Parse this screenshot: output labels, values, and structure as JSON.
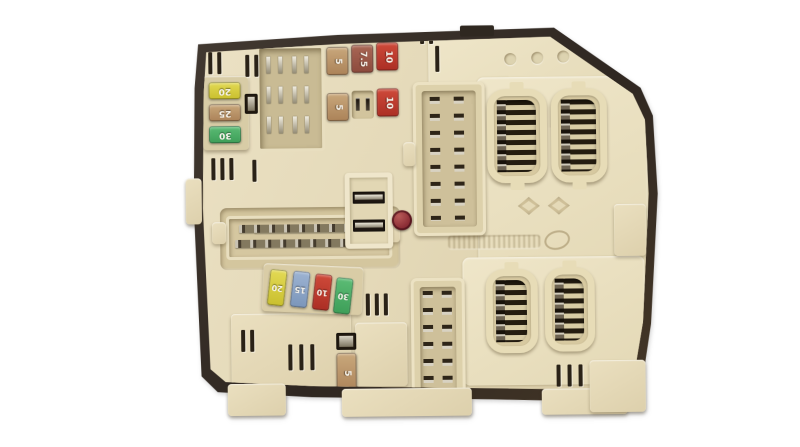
{
  "scene": {
    "description": "Photograph of a cream/beige automotive engine-bay fuse and relay box (body control fuse module) with dark brown outer frame, shown on a white background",
    "background_color": "#ffffff"
  },
  "colors": {
    "frame": "#332b23",
    "body": "#e6dcbd",
    "body_light": "#efe7cd",
    "recess": "#c9ba93",
    "slot_dark": "#2a2217",
    "metal_pin": "#d8d3c6",
    "seal_red": "#8c2e36",
    "fuse_yellow": "#d6cc42",
    "fuse_tan": "#bb9468",
    "fuse_green": "#4cab66",
    "fuse_red": "#bd3c2f",
    "fuse_brown": "#9c5847",
    "fuse_blue": "#8ca4c6"
  },
  "fuses": {
    "left_column": [
      {
        "label": "20",
        "color": "#d6cc42"
      },
      {
        "label": "25",
        "color": "#bb9468"
      },
      {
        "label": "30",
        "color": "#4cab66"
      }
    ],
    "upper_bank_row1": [
      {
        "label": "5",
        "color": "#bb9468"
      },
      {
        "label": "7.5",
        "color": "#9c5847"
      },
      {
        "label": "10",
        "color": "#bd3c2f"
      }
    ],
    "upper_bank_row2": [
      {
        "label": "5",
        "color": "#bb9468"
      },
      {
        "label": "10",
        "color": "#bd3c2f"
      }
    ],
    "middle_row": [
      {
        "label": "20",
        "color": "#d6cc42"
      },
      {
        "label": "15",
        "color": "#8ca4c6"
      },
      {
        "label": "10",
        "color": "#bd3c2f"
      },
      {
        "label": "30",
        "color": "#4cab66"
      }
    ],
    "lower_single": [
      {
        "label": "5",
        "color": "#bb9468"
      }
    ]
  },
  "markings": {
    "brand_diamond_count": 2,
    "molded_symbol_count": 3,
    "embossed_part_code_legible": false,
    "red_inspection_seal": true
  },
  "connectors": {
    "oval_socket_count": 4,
    "relay_socket_count": 1,
    "multi_pin_connector_count": 3
  }
}
